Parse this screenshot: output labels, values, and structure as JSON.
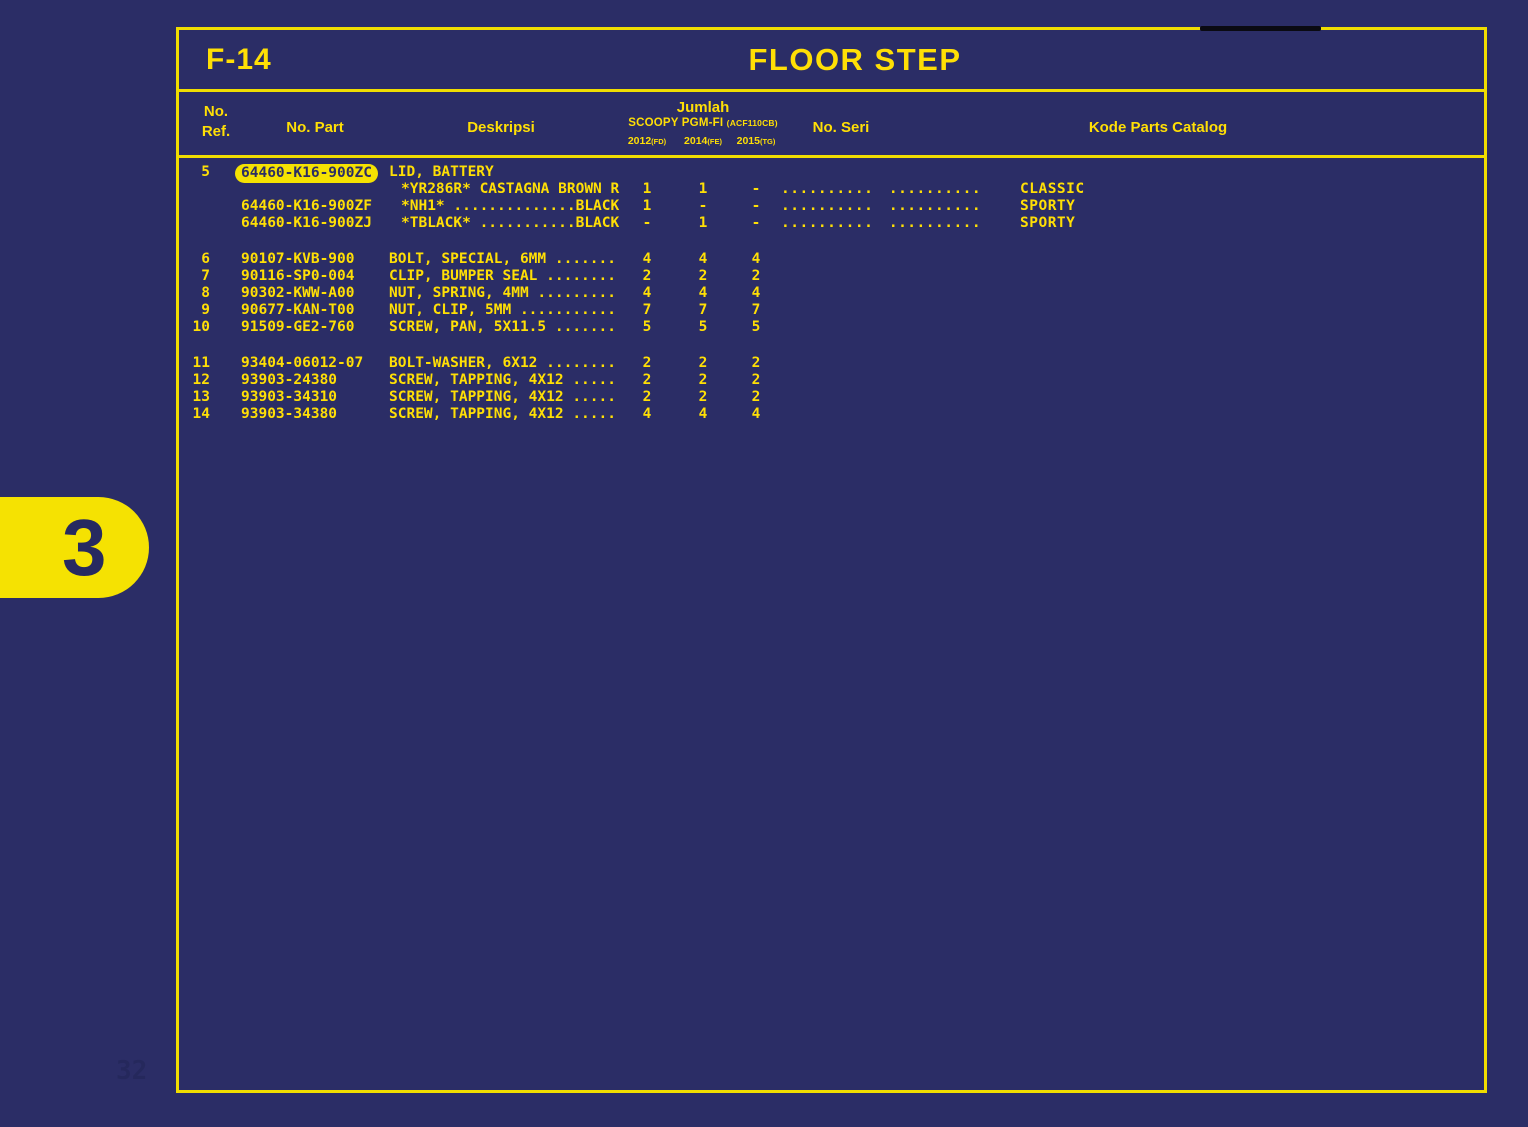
{
  "page": {
    "code": "F-14",
    "title": "FLOOR STEP",
    "tab_number": "3",
    "watermark": "32"
  },
  "colors": {
    "background": "#2b2d66",
    "frame_yellow": "#f0dd00",
    "text_yellow": "#ffdf05",
    "highlight_pill": "#f5e202",
    "pill_text_navy": "#2b2d66",
    "black_mark": "#0a0a12"
  },
  "table": {
    "headers": {
      "ref_line1": "No.",
      "ref_line2": "Ref.",
      "part": "No. Part",
      "desc": "Deskripsi",
      "jumlah": "Jumlah",
      "model": "SCOOPY PGM-FI",
      "model_code": "(ACF110CB)",
      "years": [
        {
          "year": "2012",
          "code": "(FD)"
        },
        {
          "year": "2014",
          "code": "(FE)"
        },
        {
          "year": "2015",
          "code": "(TG)"
        }
      ],
      "seri": "No. Seri",
      "kode": "Kode Parts Catalog"
    },
    "groups": [
      [
        {
          "ref": "5",
          "part": "64460-K16-900ZC",
          "highlight": true,
          "desc": "LID, BATTERY",
          "q": [
            "",
            "",
            ""
          ],
          "seri": [
            "",
            ""
          ],
          "kode": ""
        },
        {
          "ref": "",
          "part": "",
          "desc": "*YR286R* CASTAGNA BROWN R",
          "indent": true,
          "q": [
            "1",
            "1",
            "-"
          ],
          "seri": [
            "..........",
            ".........."
          ],
          "kode": "CLASSIC"
        },
        {
          "ref": "",
          "part": "64460-K16-900ZF",
          "desc": "*NH1* ..............BLACK",
          "indent": true,
          "q": [
            "1",
            "-",
            "-"
          ],
          "seri": [
            "..........",
            ".........."
          ],
          "kode": "SPORTY"
        },
        {
          "ref": "",
          "part": "64460-K16-900ZJ",
          "desc": "*TBLACK* ...........BLACK",
          "indent": true,
          "q": [
            "-",
            "1",
            "-"
          ],
          "seri": [
            "..........",
            ".........."
          ],
          "kode": "SPORTY"
        }
      ],
      [
        {
          "ref": "6",
          "part": "90107-KVB-900",
          "desc": "BOLT, SPECIAL, 6MM .......",
          "q": [
            "4",
            "4",
            "4"
          ],
          "seri": [
            "",
            ""
          ],
          "kode": ""
        },
        {
          "ref": "7",
          "part": "90116-SP0-004",
          "desc": "CLIP, BUMPER SEAL ........",
          "q": [
            "2",
            "2",
            "2"
          ],
          "seri": [
            "",
            ""
          ],
          "kode": ""
        },
        {
          "ref": "8",
          "part": "90302-KWW-A00",
          "desc": "NUT, SPRING, 4MM .........",
          "q": [
            "4",
            "4",
            "4"
          ],
          "seri": [
            "",
            ""
          ],
          "kode": ""
        },
        {
          "ref": "9",
          "part": "90677-KAN-T00",
          "desc": "NUT, CLIP, 5MM ...........",
          "q": [
            "7",
            "7",
            "7"
          ],
          "seri": [
            "",
            ""
          ],
          "kode": ""
        },
        {
          "ref": "10",
          "part": "91509-GE2-760",
          "desc": "SCREW, PAN, 5X11.5 .......",
          "q": [
            "5",
            "5",
            "5"
          ],
          "seri": [
            "",
            ""
          ],
          "kode": ""
        }
      ],
      [
        {
          "ref": "11",
          "part": "93404-06012-07",
          "desc": "BOLT-WASHER, 6X12 ........",
          "q": [
            "2",
            "2",
            "2"
          ],
          "seri": [
            "",
            ""
          ],
          "kode": ""
        },
        {
          "ref": "12",
          "part": "93903-24380",
          "desc": "SCREW, TAPPING, 4X12 .....",
          "q": [
            "2",
            "2",
            "2"
          ],
          "seri": [
            "",
            ""
          ],
          "kode": ""
        },
        {
          "ref": "13",
          "part": "93903-34310",
          "desc": "SCREW, TAPPING, 4X12 .....",
          "q": [
            "2",
            "2",
            "2"
          ],
          "seri": [
            "",
            ""
          ],
          "kode": ""
        },
        {
          "ref": "14",
          "part": "93903-34380",
          "desc": "SCREW, TAPPING, 4X12 .....",
          "q": [
            "4",
            "4",
            "4"
          ],
          "seri": [
            "",
            ""
          ],
          "kode": ""
        }
      ]
    ]
  }
}
